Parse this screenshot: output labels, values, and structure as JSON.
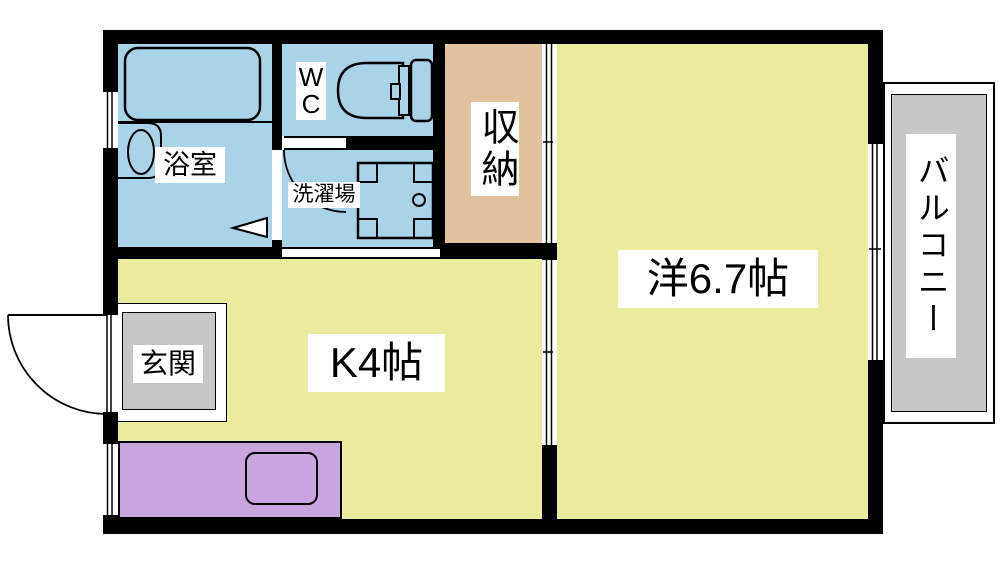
{
  "colors": {
    "wall": "#000000",
    "room-blue": "#a9d4e8",
    "room-yellow": "#ebeb9d",
    "room-tan": "#e0c29e",
    "floor-gray": "#c7c7c7",
    "counter-purple": "#c9a5de",
    "label-bg": "#ffffff"
  },
  "rooms": {
    "bathroom": {
      "label": "浴室"
    },
    "toilet": {
      "label": "W\nC"
    },
    "laundry": {
      "label": "洗濯場"
    },
    "storage": {
      "label": "収納"
    },
    "western_room": {
      "label": "洋6.7帖"
    },
    "kitchen": {
      "label": "K4帖"
    },
    "entrance": {
      "label": "玄関"
    },
    "balcony": {
      "label": "バルコニー"
    }
  }
}
